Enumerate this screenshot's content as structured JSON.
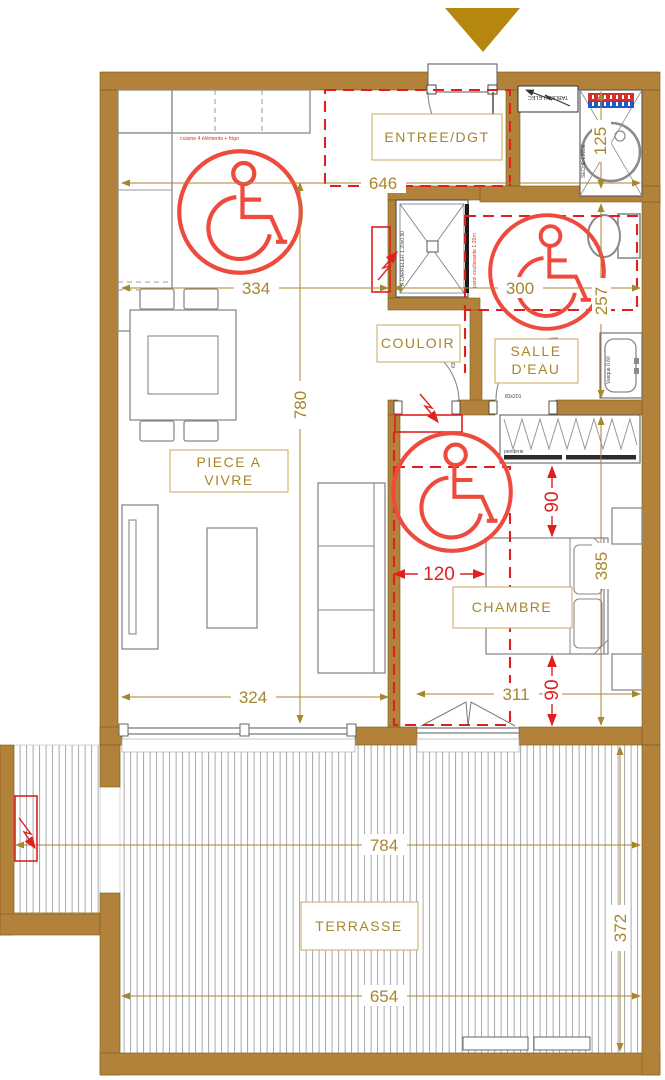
{
  "plan": {
    "rooms": {
      "entree": "ENTREE/DGT",
      "couloir": "COULOIR",
      "salle_eau_l1": "SALLE",
      "salle_eau_l2": "D'EAU",
      "piece_vivre_l1": "PIECE A",
      "piece_vivre_l2": "VIVRE",
      "chambre": "CHAMBRE",
      "terrasse": "TERRASSE"
    },
    "dimensions_gold": {
      "entree_width": "646",
      "kitchen_width": "334",
      "living_height": "780",
      "elec_recess": "125",
      "bath_width": "300",
      "bath_height": "257",
      "living_width": "324",
      "bedroom_width": "311",
      "bedroom_height": "385",
      "terrace_width_overall": "784",
      "terrace_depth": "372",
      "terrace_width_main": "654"
    },
    "dimensions_red": {
      "clearance_top": "90",
      "clearance_side": "120",
      "clearance_bottom": "90"
    },
    "annotations": {
      "kitchen_note": "cuisine 4 éléments + frigo",
      "tableau_elec": "TABLEAU ELEC",
      "shower_note": "A CARRELER 1.20x0.90",
      "shower_screen": "paroi coulissante 1.20m",
      "door_couloir": "63x203",
      "door_bath": "83x201",
      "vanity": "Vasque 0.60",
      "laundry": "SECHE-LINGE",
      "wardrobe": "penderie"
    },
    "colors": {
      "wall": "#B2823B",
      "gold": "#A8862C",
      "red": "#E02020",
      "triangle": "#B5870E"
    }
  }
}
